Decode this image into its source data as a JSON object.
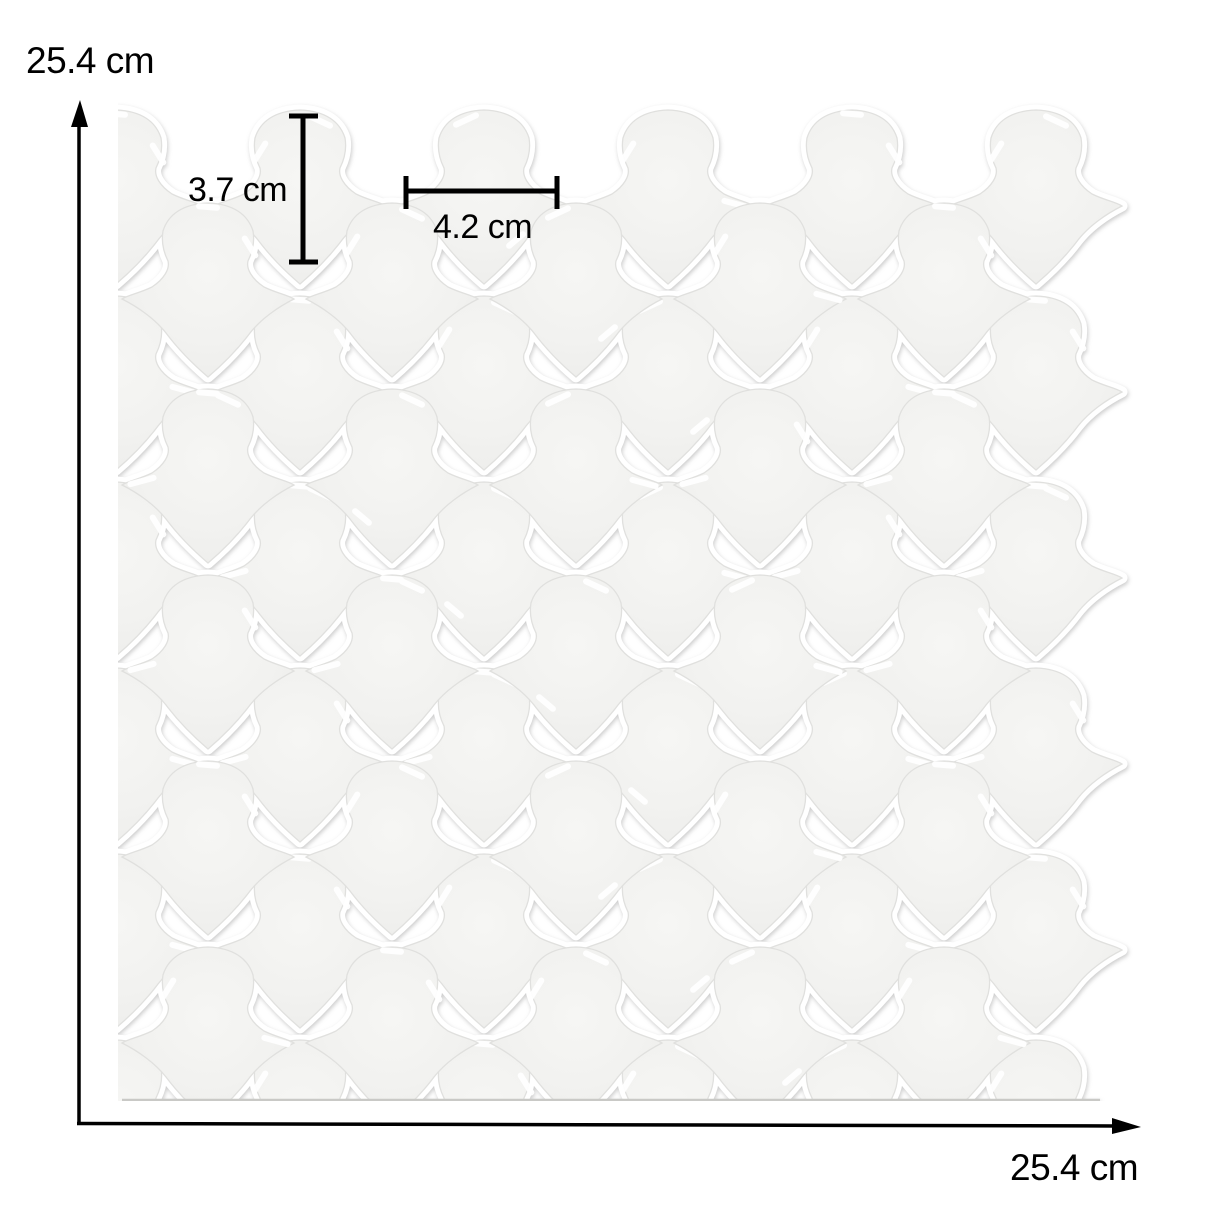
{
  "image": {
    "description": "Top view of a white glossy arabesque lantern-pattern peel-and-stick tile sheet annotated with dimensions",
    "background_color": "#ffffff",
    "pattern": "arabesque-lantern-mosaic"
  },
  "annotations": {
    "sheet_height_label": "25.4 cm",
    "sheet_width_label": "25.4 cm",
    "tile_height_label": "3.7 cm",
    "tile_width_label": "4.2 cm",
    "color": "#000000"
  },
  "sheet": {
    "tile_color": "#f2f2f0",
    "tile_color_light": "#f6f6f4",
    "tile_color_dark": "#eaeae8",
    "grout_color": "#ffffff",
    "edge_color": "#e0e0de",
    "highlight_color": "#ffffff",
    "bottom_edge_shadow": "#c9c9c6"
  }
}
